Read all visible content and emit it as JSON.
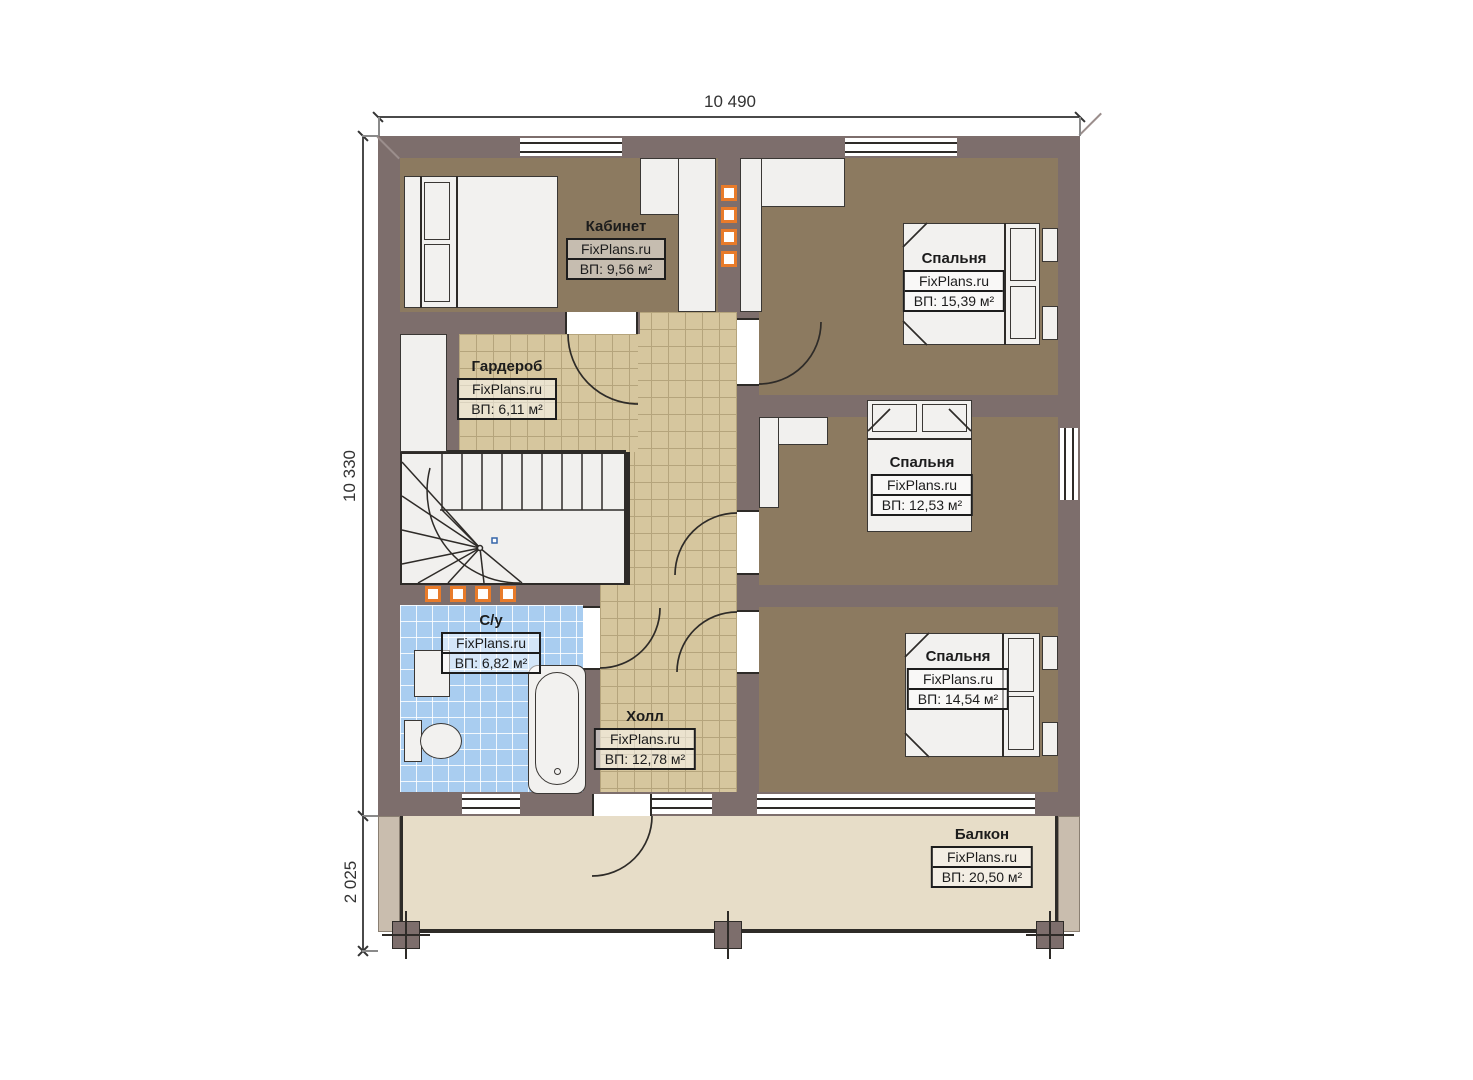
{
  "watermark": "FixPlans.ru",
  "dimensions": {
    "top": "10 490",
    "left": "10 330",
    "bottom_left": "2 025"
  },
  "rooms": [
    {
      "name": "Кабинет",
      "area": "ВП: 9,56 м²"
    },
    {
      "name": "Гардероб",
      "area": "ВП: 6,11 м²"
    },
    {
      "name": "Спальня",
      "area": "ВП: 15,39 м²"
    },
    {
      "name": "Спальня",
      "area": "ВП: 12,53 м²"
    },
    {
      "name": "Спальня",
      "area": "ВП: 14,54 м²"
    },
    {
      "name": "С/у",
      "area": "ВП: 6,82 м²"
    },
    {
      "name": "Холл",
      "area": "ВП: 12,78 м²"
    },
    {
      "name": "Балкон",
      "area": "ВП: 20,50 м²"
    }
  ],
  "colors": {
    "wall": "#7d6e6c",
    "room_floor": "#8c7a60",
    "hall_tile": "#d6c69e",
    "bath_tile": "#a9cdf0",
    "balcony_floor": "#e7ddc8",
    "accent_orange": "#e87b2a"
  }
}
